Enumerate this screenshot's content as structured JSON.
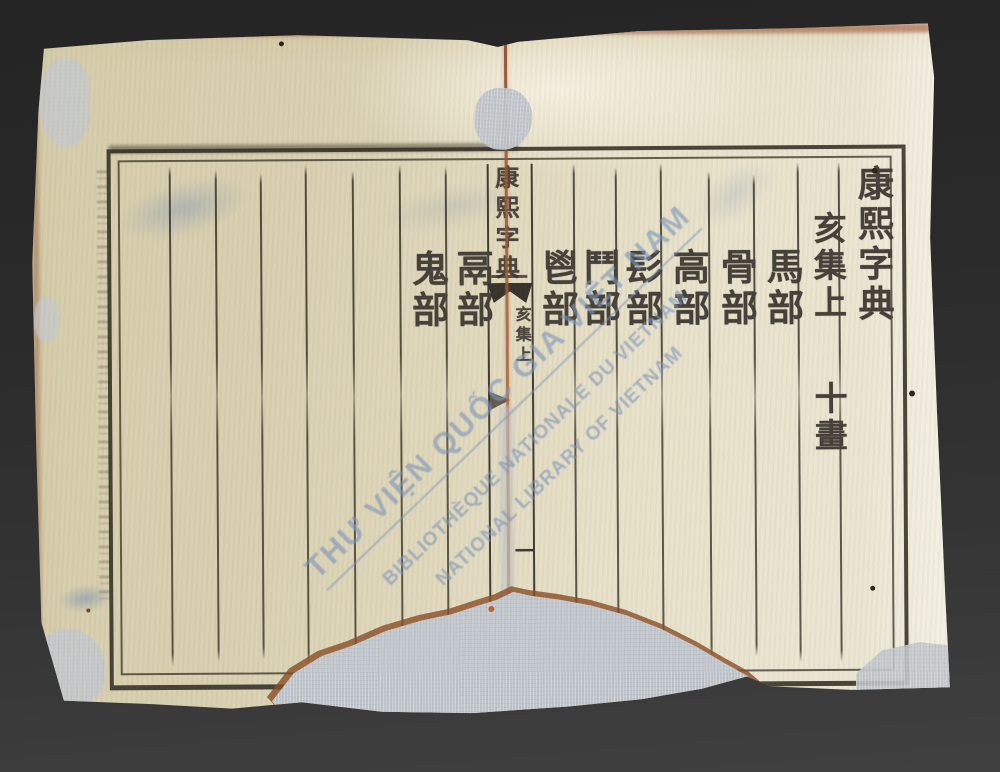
{
  "document": {
    "kind": "Scanned double page of a woodblock-printed Chinese dictionary",
    "title": "康熙字典",
    "right_page": {
      "header_title": "康熙字典",
      "volume_line": "亥集上",
      "strokes_line": "十畫",
      "radical_columns": [
        "馬部",
        "骨部",
        "高部",
        "髟部",
        "鬥部",
        "鬯部"
      ]
    },
    "left_page": {
      "radical_columns": [
        "鬲部",
        "鬼部"
      ]
    },
    "center_fold": {
      "title": "康熙字典",
      "divider": "一",
      "volume": "亥集上",
      "page_number": "一"
    }
  },
  "watermark": {
    "line1": "THƯ VIỆN QUỐC GIA VIỆT NAM",
    "line2": "BIBLIOTHÈQUE NATIONALE DU VIETNAM",
    "line3": "NATIONAL LIBRARY OF VIETNAM",
    "color": "#7b95ba"
  },
  "palette": {
    "background": "#2e2d2c",
    "paper_left": "#d8cfae",
    "paper_right": "#ebe5d2",
    "ink": "#453f36",
    "fold_crease": "#a15d39",
    "repair_patch": "#bfc5cc",
    "burn_edge": "#8a4e26"
  }
}
